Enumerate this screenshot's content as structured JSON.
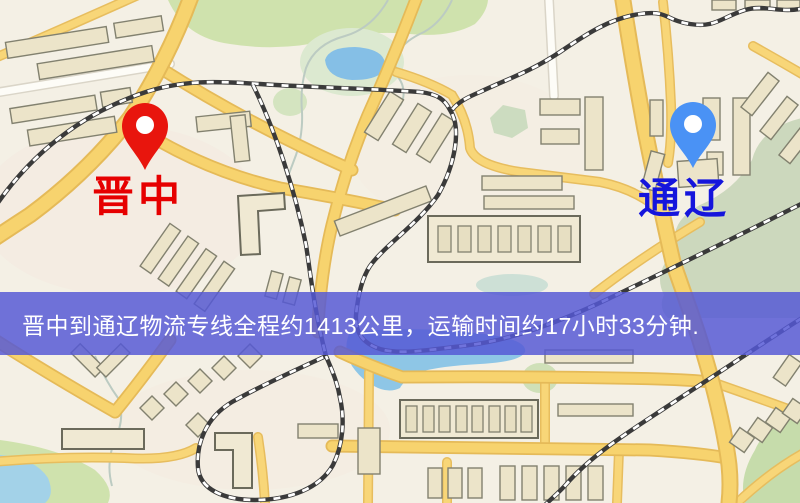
{
  "map": {
    "origin": {
      "name": "晋中",
      "pin_color": "#e8150d",
      "label_color": "#e60000"
    },
    "destination": {
      "name": "通辽",
      "pin_color": "#4a92f5",
      "label_color": "#1515dc"
    },
    "banner": {
      "text": "晋中到通辽物流专线全程约1413公里，运输时间约17小时33分钟.",
      "background_color": "#5558d5",
      "text_color": "#ffffff"
    },
    "route": {
      "origin_city": "晋中",
      "destination_city": "通辽",
      "distance_text": "约1413公里",
      "duration_text": "约17小时33分钟"
    }
  }
}
